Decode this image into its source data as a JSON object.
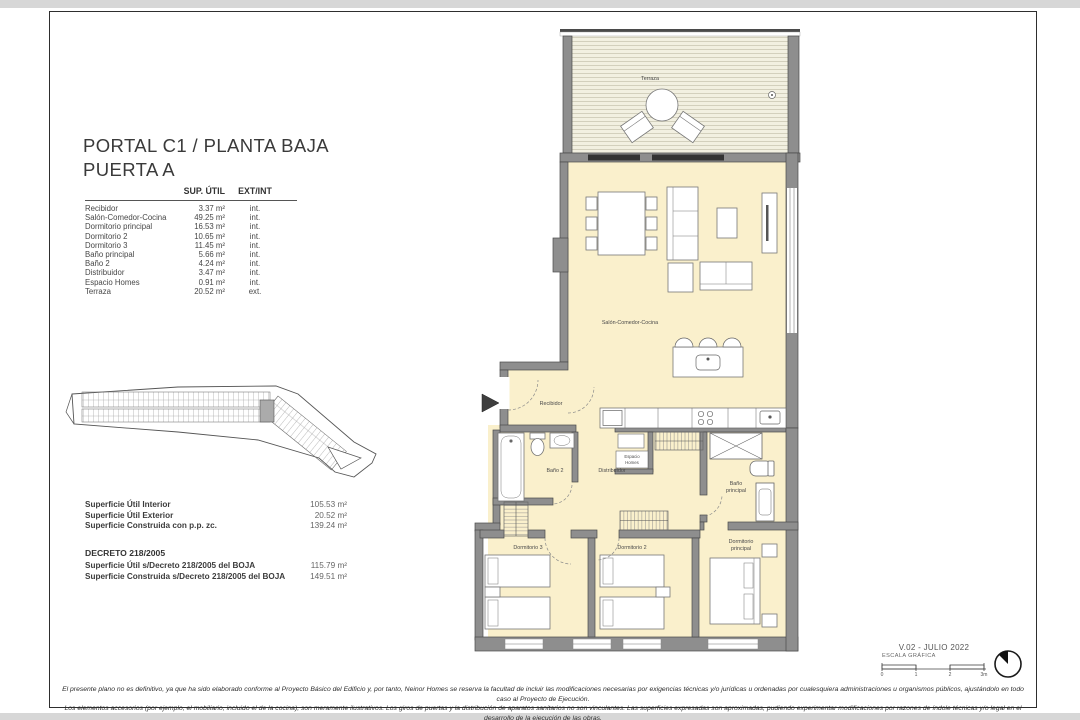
{
  "colors": {
    "wall_gray": "#8e8e8e",
    "room_cream": "#faf0cc",
    "deck_bg": "#f2f0e1",
    "highlight_unit": "#ababab",
    "page_strip": "#d7d7d7"
  },
  "title": {
    "line1": "PORTAL C1 / PLANTA BAJA",
    "line2": "PUERTA A"
  },
  "area_table": {
    "col_area": "SUP. ÚTIL",
    "col_type": "EXT/INT",
    "rows": [
      {
        "name": "Recibidor",
        "area": "3.37 m²",
        "type": "int."
      },
      {
        "name": "Salón-Comedor-Cocina",
        "area": "49.25 m²",
        "type": "int."
      },
      {
        "name": "Dormitorio principal",
        "area": "16.53 m²",
        "type": "int."
      },
      {
        "name": "Dormitorio 2",
        "area": "10.65 m²",
        "type": "int."
      },
      {
        "name": "Dormitorio 3",
        "area": "11.45 m²",
        "type": "int."
      },
      {
        "name": "Baño principal",
        "area": "5.66 m²",
        "type": "int."
      },
      {
        "name": "Baño 2",
        "area": "4.24 m²",
        "type": "int."
      },
      {
        "name": "Distribuidor",
        "area": "3.47 m²",
        "type": "int."
      },
      {
        "name": "Espacio Homes",
        "area": "0.91 m²",
        "type": "int."
      },
      {
        "name": "Terraza",
        "area": "20.52 m²",
        "type": "ext."
      }
    ]
  },
  "summary": {
    "rows": [
      {
        "label": "Superficie Útil Interior",
        "value": "105.53 m²"
      },
      {
        "label": "Superficie Útil Exterior",
        "value": "20.52 m²"
      },
      {
        "label": "Superficie Construida con p.p. zc.",
        "value": "139.24 m²"
      }
    ]
  },
  "decreto": {
    "heading": "DECRETO 218/2005",
    "rows": [
      {
        "label": "Superficie Útil s/Decreto 218/2005 del BOJA",
        "value": "115.79 m²"
      },
      {
        "label": "Superficie Construida s/Decreto 218/2005 del BOJA",
        "value": "149.51 m²"
      }
    ]
  },
  "plan": {
    "labels": {
      "terraza": "Terraza",
      "salon": "Salón-Comedor-Cocina",
      "recibidor": "Recibidor",
      "banyo2": "Baño 2",
      "distribuidor": "Distribuidor",
      "espacio_1": "Espacio",
      "espacio_2": "Homes",
      "banyo_ppal_1": "Baño",
      "banyo_ppal_2": "principal",
      "dorm3": "Dormitorio 3",
      "dorm2": "Dormitorio 2",
      "dorm_ppal_1": "Dormitorio",
      "dorm_ppal_2": "principal"
    }
  },
  "footer": {
    "version": "V.02 - JULIO 2022",
    "scale_label": "ESCALA GRÁFICA",
    "scale_ticks": [
      "0",
      "1",
      "2",
      "3m"
    ],
    "disclaimer_1": "El presente plano no es definitivo, ya que ha sido elaborado conforme al Proyecto Básico del Edificio y, por tanto, Neinor Homes se reserva la facultad de incluir las modificaciones necesarias por exigencias técnicas y/o jurídicas u ordenadas por cualesquiera administraciones u organismos públicos, ajustándolo en todo caso al Proyecto de Ejecución.",
    "disclaimer_2": "Los elementos accesorios (por ejemplo, el mobiliario, incluido el de la cocina), son meramente ilustrativos. Los giros de puertas y la distribución de aparatos sanitarios no son vinculantes. Las superficies expresadas son aproximadas, pudiendo experimentar modificaciones por razones de índole técnicas y/o legal en el desarrollo de la ejecución de las obras."
  }
}
